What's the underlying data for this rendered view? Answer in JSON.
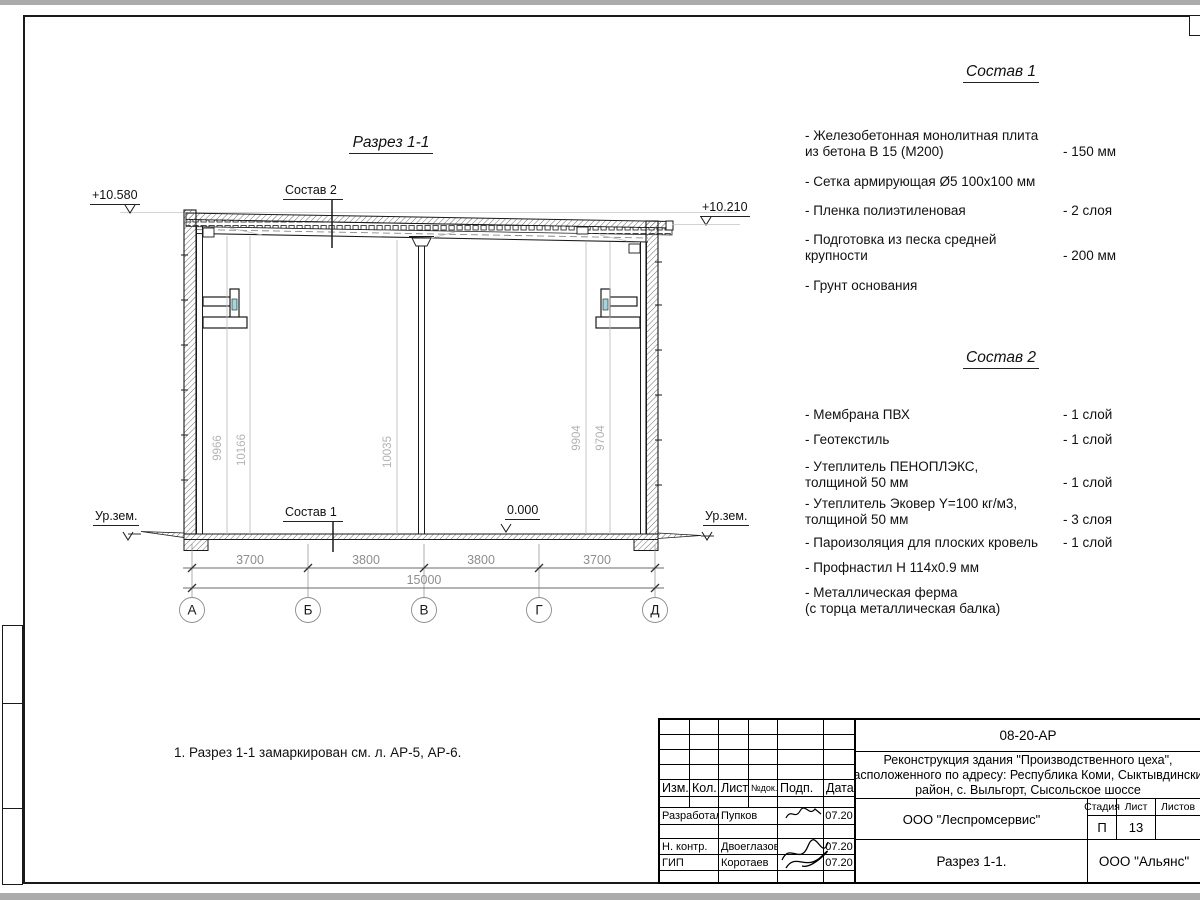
{
  "page": {
    "note": "1. Разрез 1-1 замаркирован см. л. АР-5, АР-6."
  },
  "section": {
    "title": "Разрез 1-1",
    "label_sostav1": "Состав 1",
    "label_sostav2": "Состав 2",
    "elev_top_left": "+10.580",
    "elev_top_right": "+10.210",
    "elev_zero": "0.000",
    "ground_left": "Ур.зем.",
    "ground_right": "Ур.зем.",
    "vertical_dims": [
      "9966",
      "10166",
      "10035",
      "9904",
      "9704"
    ],
    "horizontal_dims": [
      "3700",
      "3800",
      "3800",
      "3700"
    ],
    "total_dim": "15000",
    "axes": [
      "А",
      "Б",
      "В",
      "Г",
      "Д"
    ]
  },
  "sostav1": {
    "title": "Состав 1",
    "items": [
      {
        "line1": "- Железобетонная  монолитная плита",
        "line2": "из бетона В 15 (М200)",
        "value": "- 150 мм"
      },
      {
        "line1": "- Сетка армирующая Ø5 100х100 мм",
        "line2": "",
        "value": ""
      },
      {
        "line1": "- Пленка полиэтиленовая",
        "line2": "",
        "value": "-  2 слоя"
      },
      {
        "line1": "- Подготовка из песка средней",
        "line2": "крупности",
        "value": "- 200 мм"
      },
      {
        "line1": "- Грунт основания",
        "line2": "",
        "value": ""
      }
    ]
  },
  "sostav2": {
    "title": "Состав 2",
    "items": [
      {
        "line1": "- Мембрана ПВХ",
        "line2": "",
        "value": "- 1 слой"
      },
      {
        "line1": "- Геотекстиль",
        "line2": "",
        "value": "- 1 слой"
      },
      {
        "line1": "- Утеплитель ПЕНОПЛЭКС,",
        "line2": "толщиной 50 мм",
        "value": "- 1 слой"
      },
      {
        "line1": "- Утеплитель Эковер Y=100 кг/м3,",
        "line2": "толщиной 50 мм",
        "value": "- 3 слоя"
      },
      {
        "line1": "- Пароизоляция для плоских кровель",
        "line2": "",
        "value": "- 1 слой"
      },
      {
        "line1": "- Профнастил Н 114х0.9 мм",
        "line2": "",
        "value": ""
      },
      {
        "line1": "- Металлическая ферма",
        "line2": "(с торца металлическая балка)",
        "value": ""
      }
    ]
  },
  "titleblock": {
    "doc_number": "08-20-АР",
    "project_line1": "Реконструкция здания \"Производственного цеха\",",
    "project_line2": "расположенного по адресу: Республика Коми, Сыктывдинский",
    "project_line3": "район, с. Выльгорт, Сысольское шоссе",
    "col_izm": "Изм.",
    "col_kol": "Кол.",
    "col_list": "Лист",
    "col_ndok": "№док.",
    "col_podp": "Подп.",
    "col_data": "Дата",
    "row1_role": "Разработал",
    "row1_name": "Пупков",
    "row1_date": "07.20",
    "row2_role": "Н. контр.",
    "row2_name": "Двоеглазов",
    "row2_date": "07.20",
    "row3_role": "ГИП",
    "row3_name": "Коротаев",
    "row3_date": "07.20",
    "org": "ООО \"Леспромсервис\"",
    "stage_label": "Стадия",
    "sheet_label": "Лист",
    "sheets_label": "Листов",
    "stage": "П",
    "sheet_no": "13",
    "drawing_title": "Разрез 1-1.",
    "customer": "ООО \"Альянс\""
  }
}
